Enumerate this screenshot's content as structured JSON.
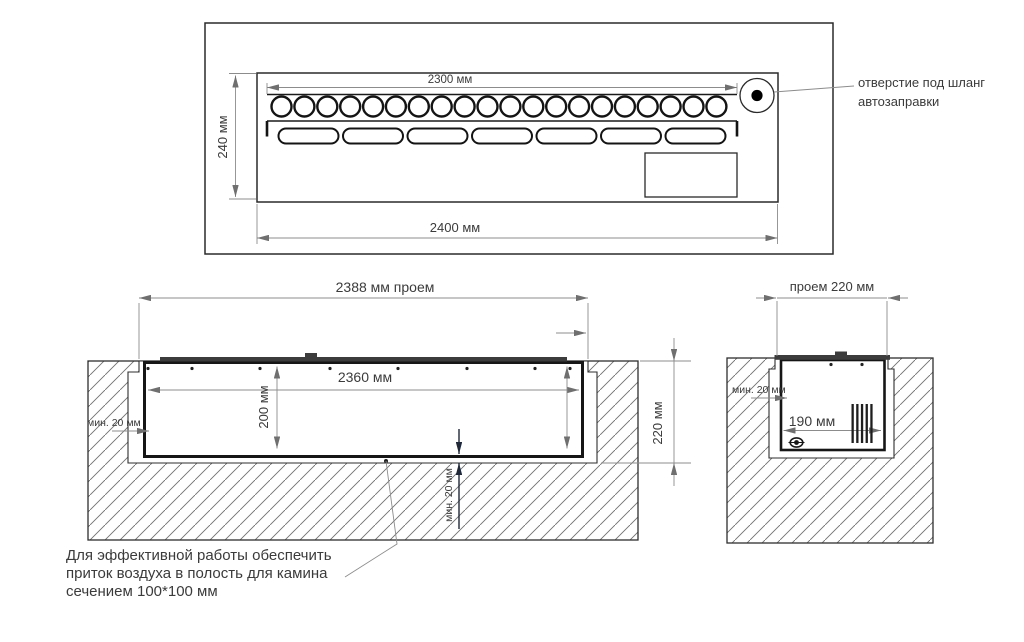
{
  "top_view": {
    "dim_burner_width": "2300 мм",
    "dim_unit_width": "2400 мм",
    "dim_unit_depth": "240 мм",
    "burner_holes_count": 20,
    "slot_count": 7,
    "callout": {
      "line1": "отверстие под шланг",
      "line2": "автозаправки"
    }
  },
  "front_view": {
    "dim_opening_width": "2388 мм проем",
    "dim_tank_inner_width": "2360 мм",
    "dim_tank_height": "200 мм",
    "dim_cavity_depth": "220 мм",
    "side_clearance": "мин. 20 мм",
    "bottom_clearance": "мин. 20 мм"
  },
  "side_view": {
    "dim_opening_depth": "проем 220 мм",
    "dim_tank_inner_depth": "190 мм",
    "side_clearance": "мин. 20 мм"
  },
  "note": {
    "line1": "Для эффективной работы обеспечить",
    "line2": "приток воздуха в полость для камина",
    "line3": "сечением 100*100 мм"
  },
  "colors": {
    "line": "#2e2e2e",
    "dim_line": "#8c8c8c",
    "text": "#3b3b3b",
    "hatch": "#6f6f6f",
    "dark_arrow": "#20293a"
  }
}
